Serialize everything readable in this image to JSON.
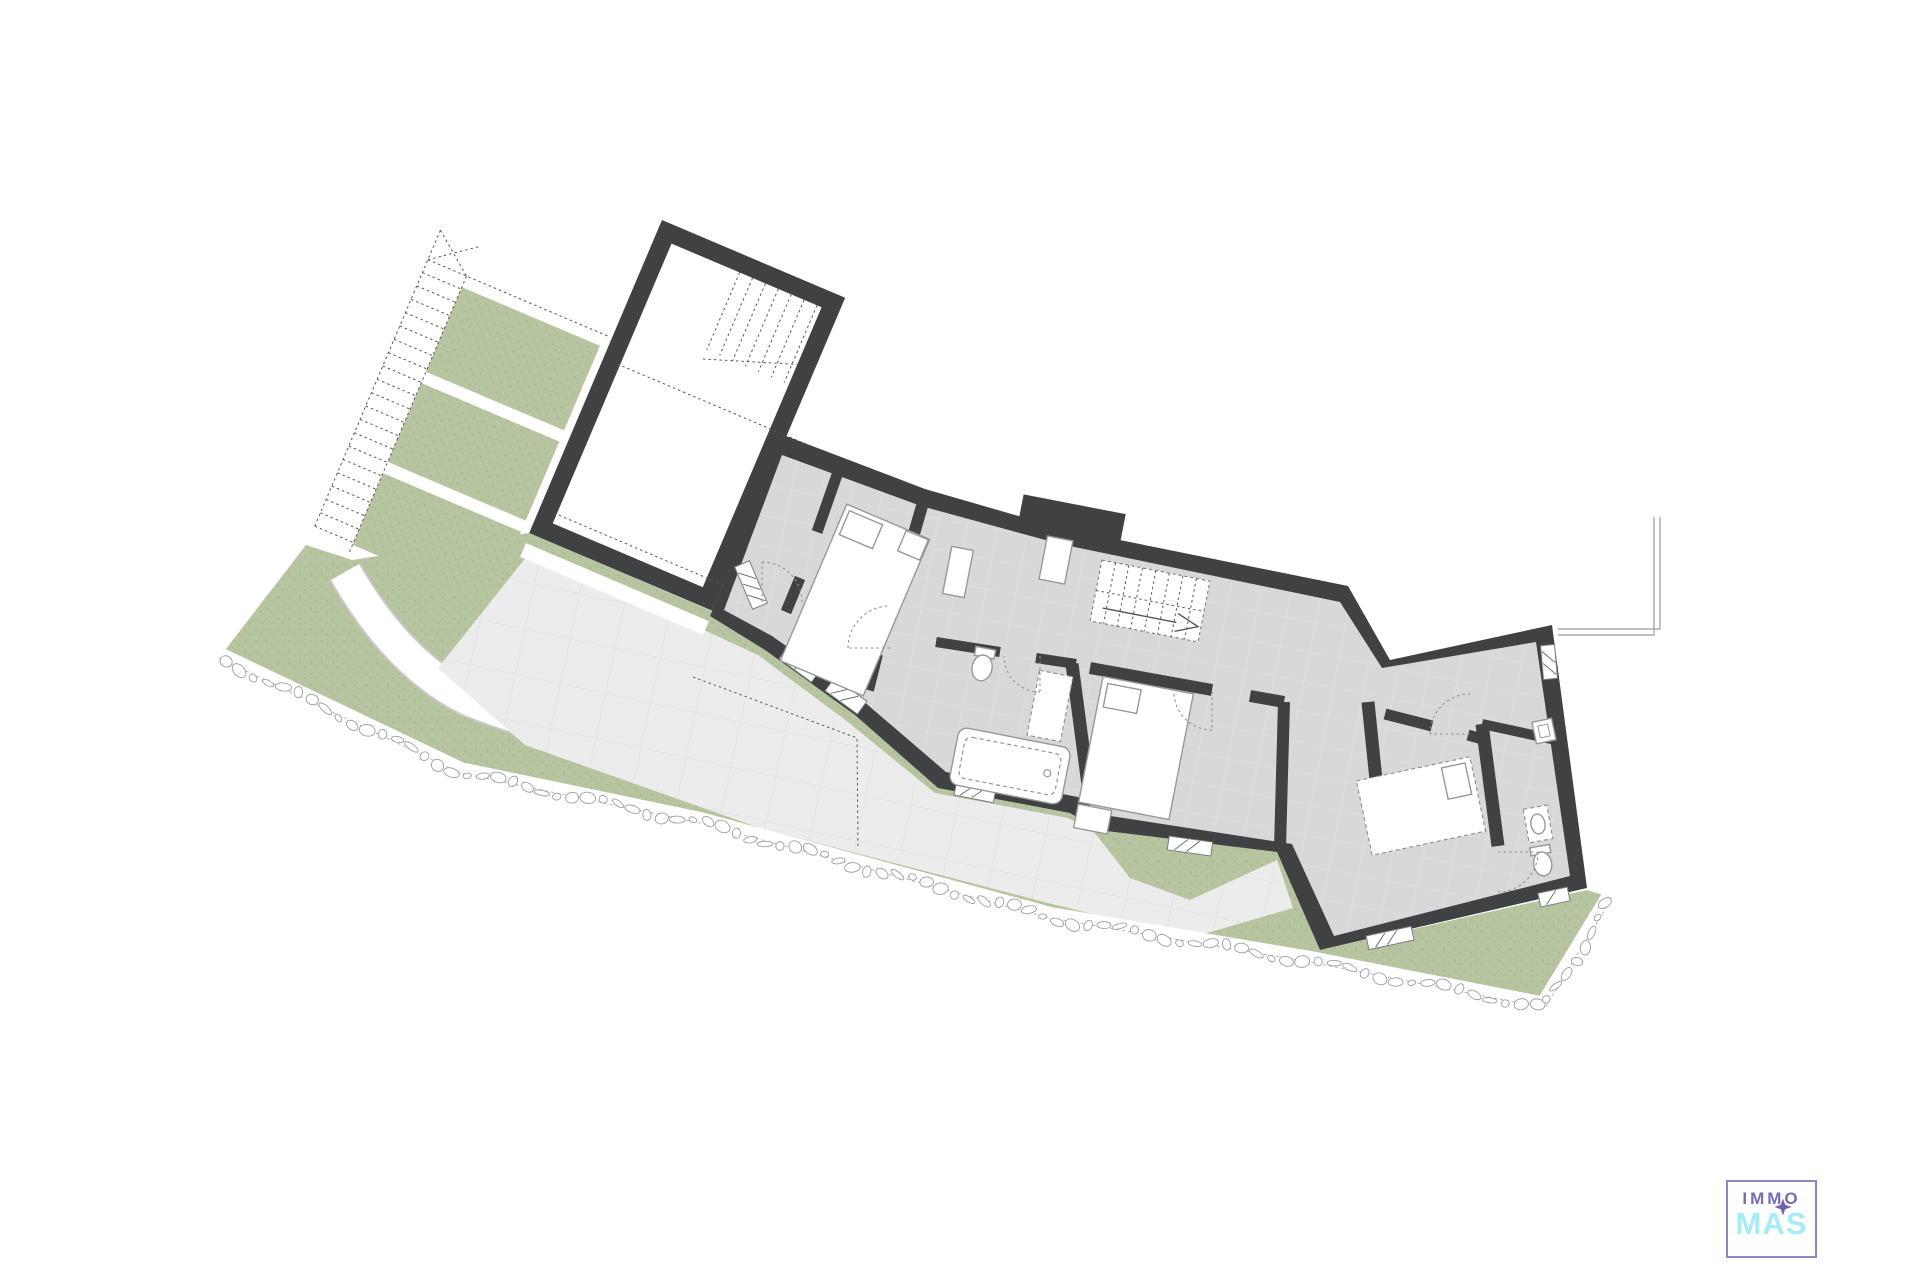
{
  "document": {
    "type": "architectural floor plan",
    "background": "#ffffff"
  },
  "logo": {
    "line1": "IMMO",
    "line2": "MAS",
    "star_icon": "four-point-star"
  },
  "colors": {
    "wall": "#3f4143",
    "floor": "#d7d8d9",
    "floor_line": "#e2e3e4",
    "terrace": "#ececed",
    "terrace_line": "#dfe0e1",
    "green": "#b7c4a0",
    "green_dot": "#a7b78d",
    "white": "#ffffff",
    "edge": "#9b9b9b",
    "stone": "#9aa0a3",
    "logo_purple": "#756cb4",
    "logo_cyan": "#a6ecf4",
    "logo_border": "#8d86c3",
    "logo_star": "#6f63ae"
  }
}
